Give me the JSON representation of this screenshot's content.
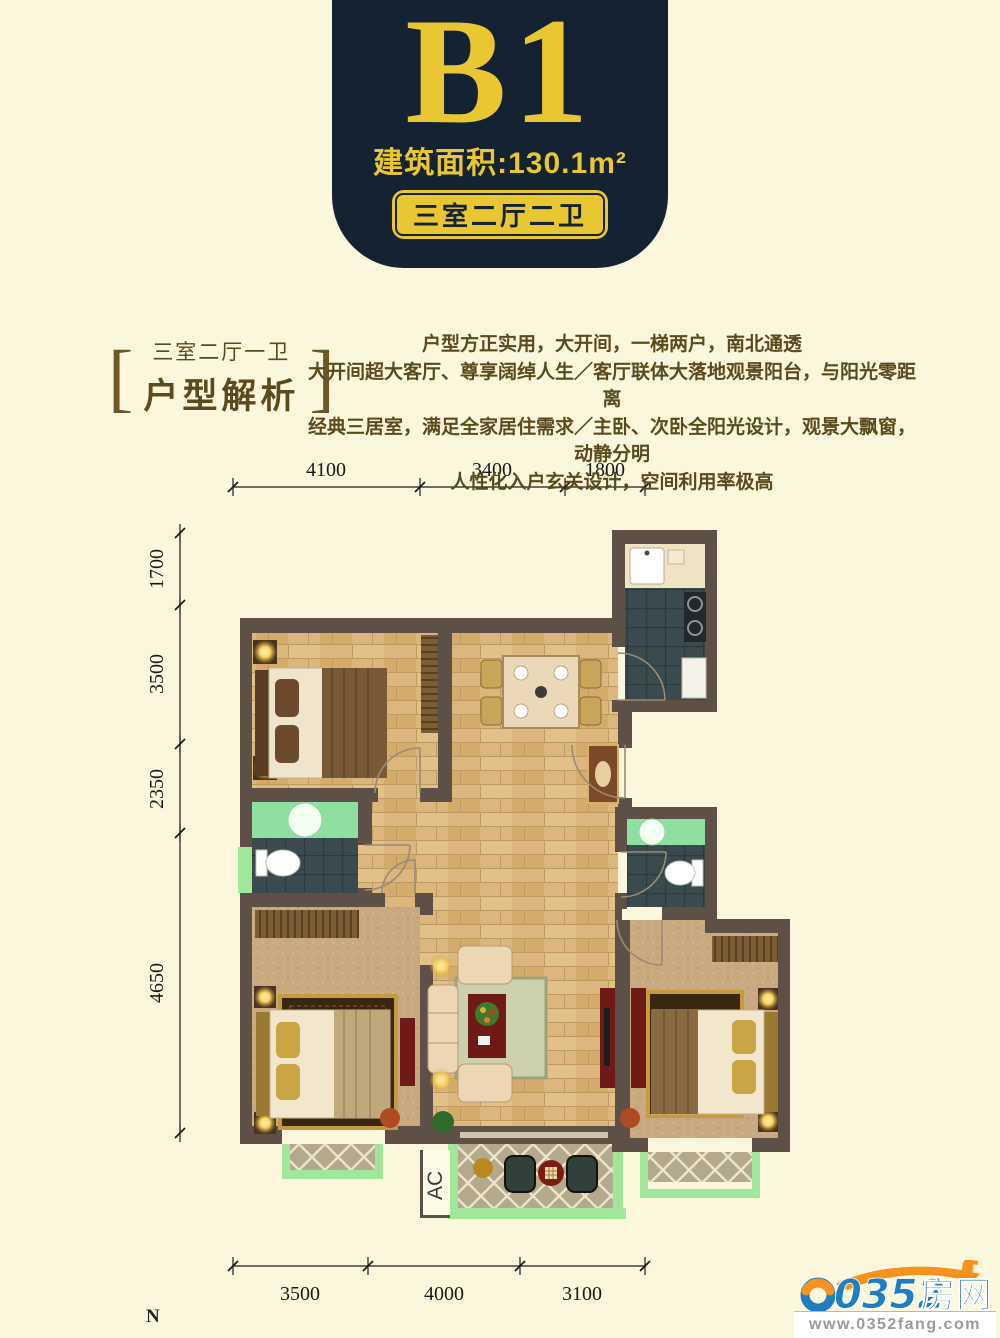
{
  "header": {
    "unit_code": "B1",
    "area_label": "建筑面积:130.1m²",
    "layout_tag": "三室二厅二卫"
  },
  "analysis": {
    "bracket_left": "[",
    "bracket_right": "]",
    "subtitle": "三室二厅一卫",
    "title": "户型解析",
    "lines": [
      "户型方正实用，大开间，一梯两户，南北通透",
      "大开间超大客厅、尊享阔绰人生／客厅联体大落地观景阳台，与阳光零距离",
      "经典三居室，满足全家居住需求／主卧、次卧全阳光设计，观景大飘窗，动静分明",
      "人性化入户玄关设计，空间利用率极高"
    ]
  },
  "plan": {
    "dims_top": [
      "4100",
      "3400",
      "1800"
    ],
    "dims_left": [
      "1700",
      "3500",
      "2350",
      "4650"
    ],
    "dims_bottom": [
      "3500",
      "4000",
      "3100"
    ],
    "ac_label": "AC",
    "compass": "N"
  },
  "footer": {
    "logo_number": "0352",
    "logo_text": "房网",
    "website": "www.0352fang.com"
  },
  "colors": {
    "background": "#fbf7dd",
    "banner_navy": "#152232",
    "gold": "#e9c733",
    "text_brown": "#5b4a1d",
    "wall": "#5e5047",
    "wood_floor": "#dcb67c",
    "window_green": "#a0e79b",
    "dark_tile": "#3a4a4e",
    "carpet": "#c9a97f",
    "accent_red": "#6e1b17",
    "logo_blue": "#1e7ec2",
    "logo_orange": "#f6921e"
  }
}
